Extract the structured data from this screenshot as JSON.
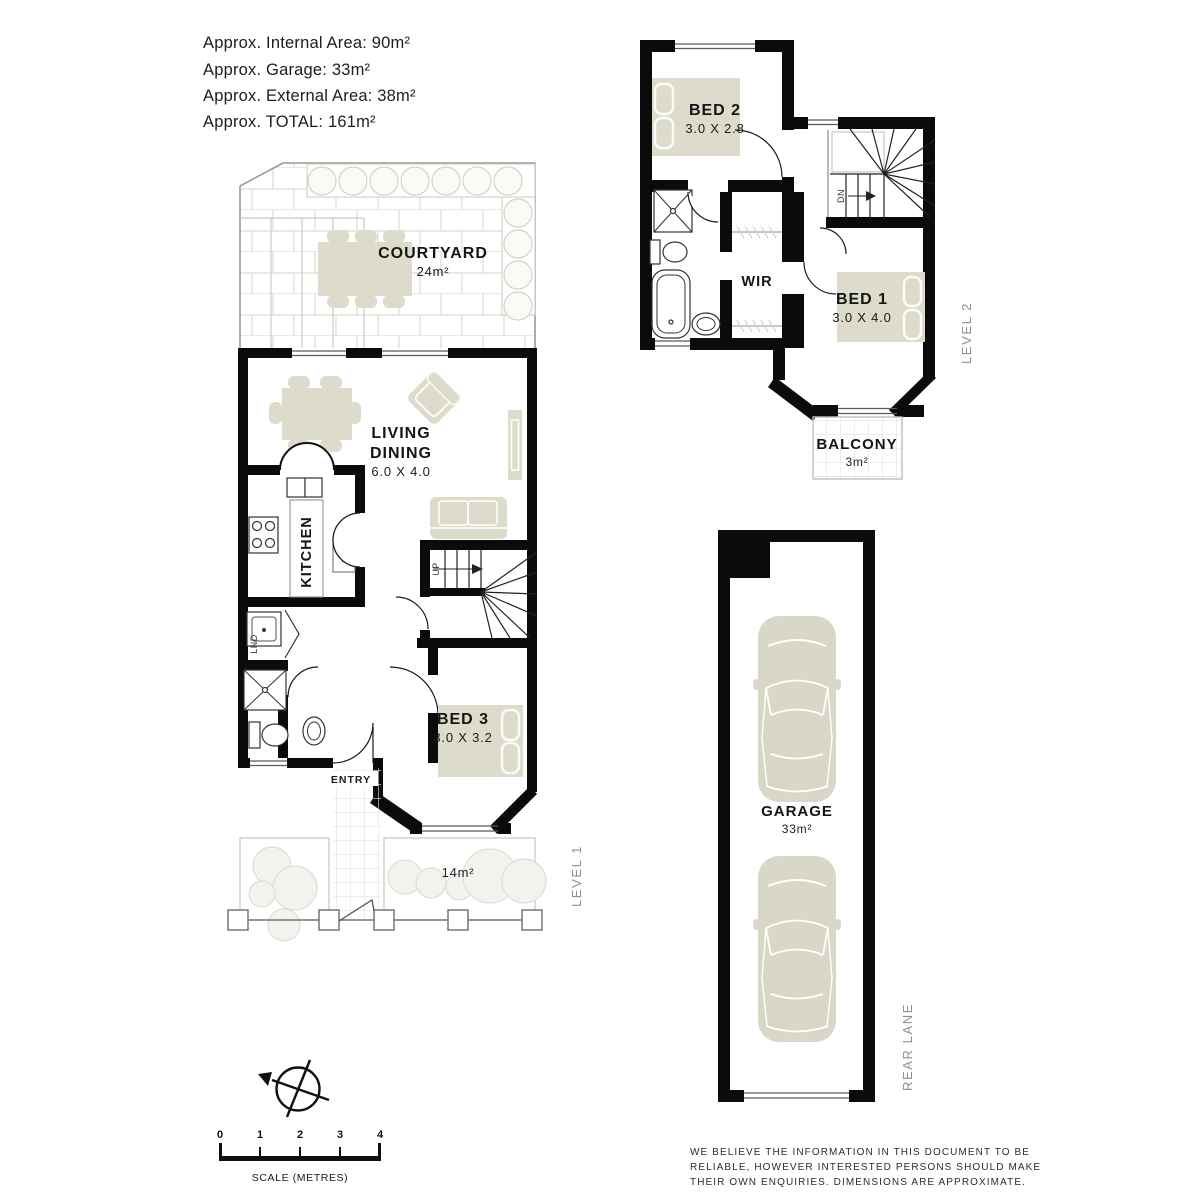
{
  "header": {
    "lines": [
      "Approx. Internal Area: 90m²",
      "Approx. Garage: 33m²",
      "Approx. External Area: 38m²",
      "Approx. TOTAL: 161m²"
    ]
  },
  "level1": {
    "label": "LEVEL 1",
    "courtyard_name": "COURTYARD",
    "courtyard_area": "24m²",
    "living_line1": "LIVING",
    "living_line2": "DINING",
    "living_dims": "6.0 X 4.0",
    "kitchen": "KITCHEN",
    "laundry": "LND",
    "dishwasher": "DW",
    "up": "UP",
    "entry": "ENTRY",
    "bed3_name": "BED 3",
    "bed3_dims": "3.0 X 3.2",
    "frontyard_area": "14m²"
  },
  "level2": {
    "label": "LEVEL 2",
    "bed2_name": "BED 2",
    "bed2_dims": "3.0 X 2.8",
    "bed1_name": "BED 1",
    "bed1_dims": "3.0 X 4.0",
    "wir": "WIR",
    "dn": "DN",
    "balcony_name": "BALCONY",
    "balcony_area": "3m²"
  },
  "garage": {
    "name": "GARAGE",
    "area": "33m²",
    "rear_lane": "REAR LANE"
  },
  "scalebar": {
    "ticks": [
      "0",
      "1",
      "2",
      "3",
      "4"
    ],
    "label": "SCALE (METRES)"
  },
  "disclaimer": {
    "lines": [
      "WE BELIEVE THE INFORMATION IN THIS DOCUMENT TO BE",
      "RELIABLE, HOWEVER INTERESTED PERSONS SHOULD MAKE",
      "THEIR OWN ENQUIRIES. DIMENSIONS ARE APPROXIMATE."
    ]
  },
  "colors": {
    "wall": "#0b0b0b",
    "furniture": "#dcdbcc",
    "car": "#d9d8c8",
    "bush": "#f3f3ed",
    "tile_line": "#e2e2da",
    "gray_text": "#8f8f8f"
  }
}
